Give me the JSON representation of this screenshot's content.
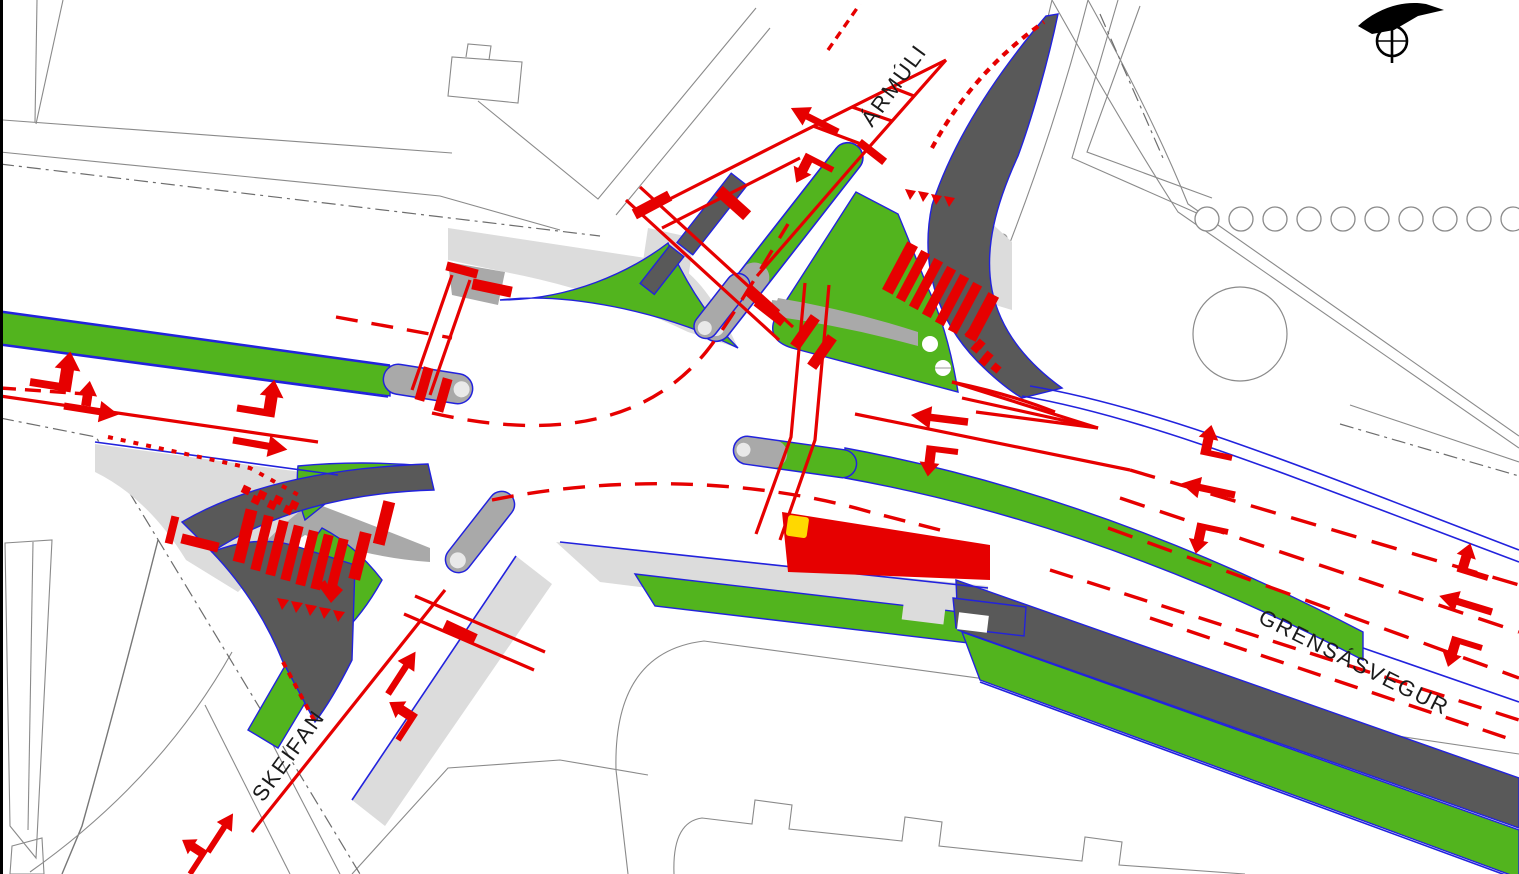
{
  "drawing": {
    "kind": "traffic engineering intersection plan",
    "streets": {
      "armuli": "ÁRMÚLI",
      "grensasvegur": "GRENSÁSVEGUR",
      "skeifan": "SKEIFAN"
    },
    "icons": {
      "north_arrow": "north-arrow"
    },
    "colors": {
      "marking_red": "#e60000",
      "grass_green": "#52b41e",
      "cycle_track_dark": "#595959",
      "sidewalk_light": "#dcdcdc",
      "path_gray": "#a9a9a9",
      "curb_blue": "#2222dd",
      "bus_shelter_yellow": "#ffd800",
      "linework_gray": "#8a8a8a",
      "frame_black": "#000000"
    }
  }
}
